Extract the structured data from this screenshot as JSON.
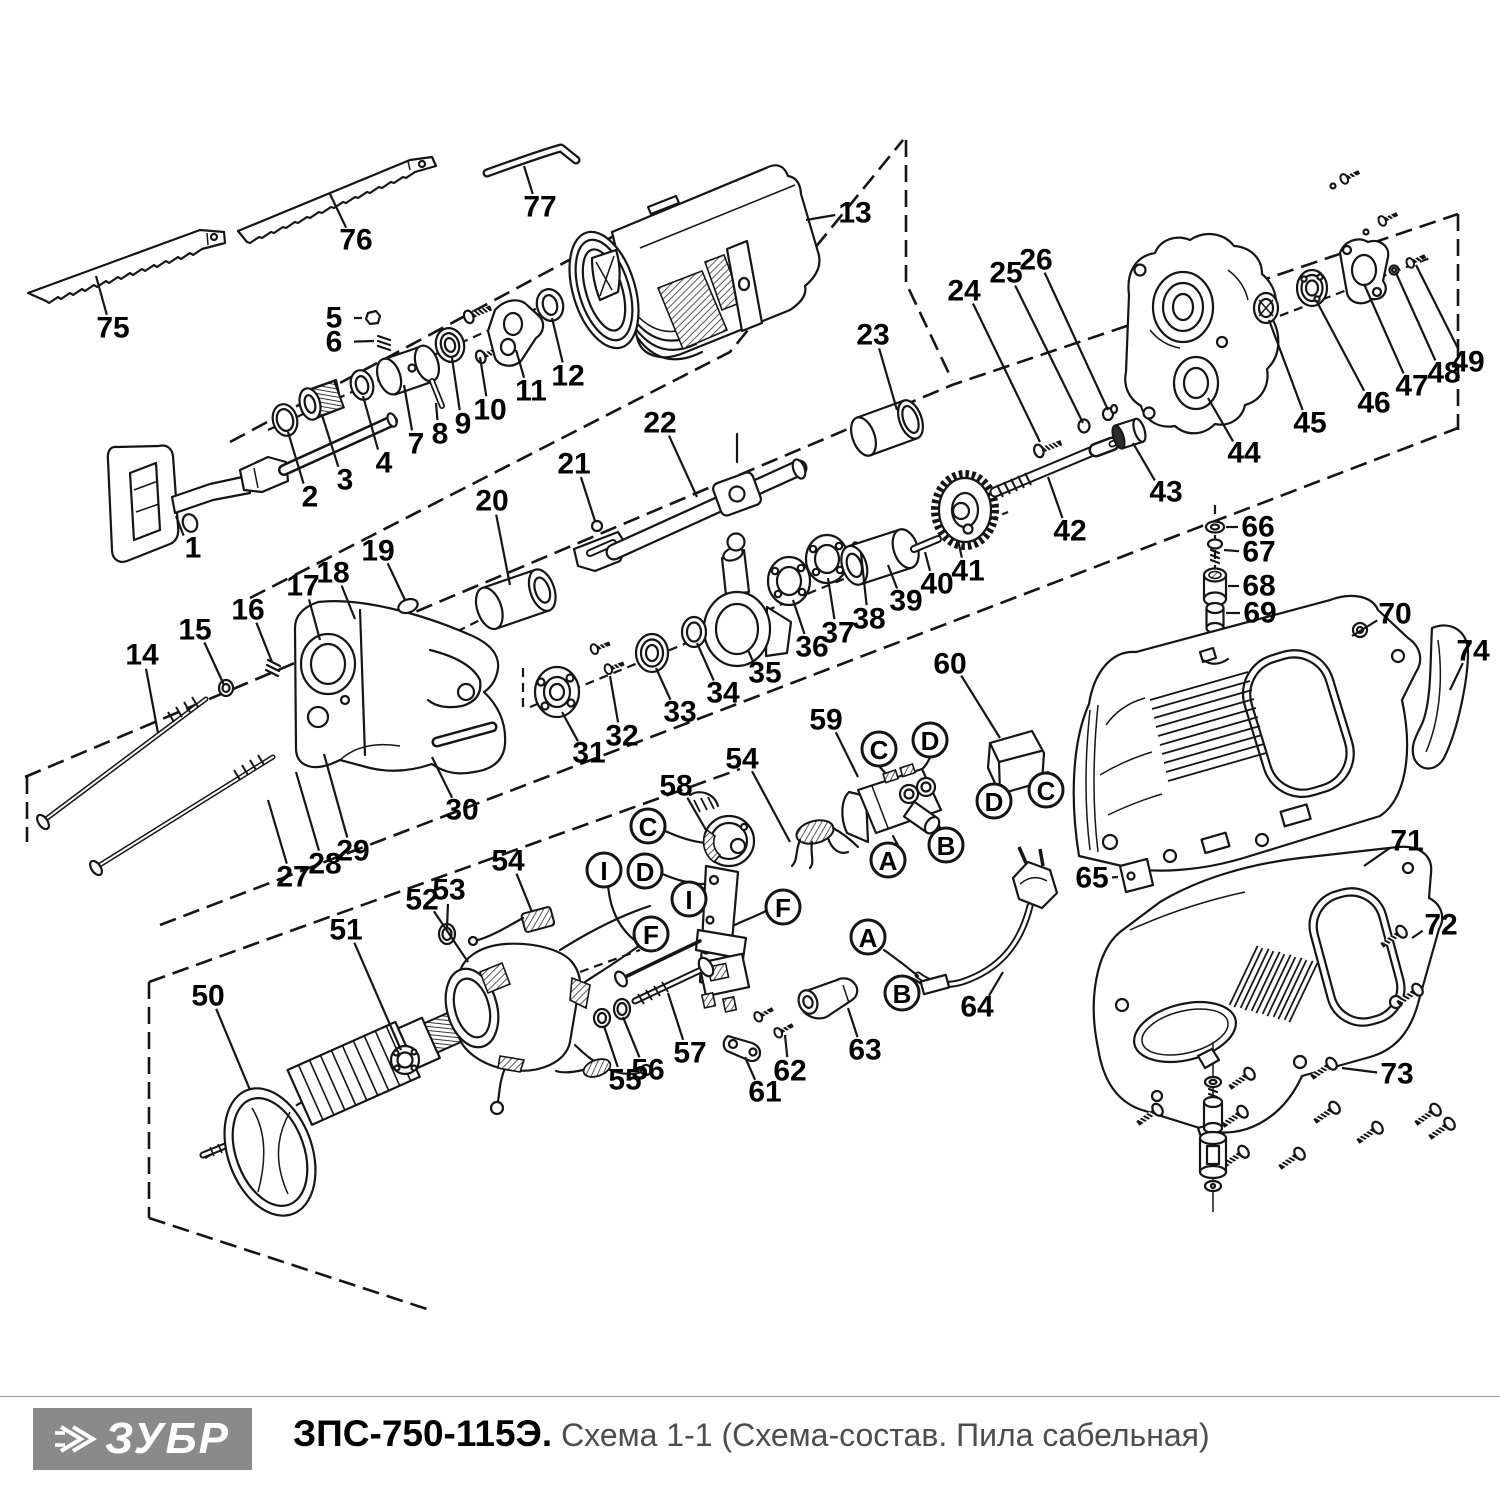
{
  "footer": {
    "brand": "ЗУБР",
    "model": "ЗПС-750-115Э.",
    "subtitle": " Схема 1-1 (Схема-состав. Пила сабельная)"
  },
  "colors": {
    "line": "#151515",
    "logo_bg": "#8a8a8a",
    "subtitle_text": "#4d4d4d"
  },
  "diagram": {
    "labels": [
      {
        "t": "1",
        "x": 193,
        "y": 548,
        "lx": 176,
        "ly": 516
      },
      {
        "t": "2",
        "x": 310,
        "y": 497,
        "lx": 288,
        "ly": 432
      },
      {
        "t": "3",
        "x": 345,
        "y": 480,
        "lx": 322,
        "ly": 415
      },
      {
        "t": "4",
        "x": 384,
        "y": 463,
        "lx": 363,
        "ly": 396
      },
      {
        "t": "5",
        "x": 334,
        "y": 318,
        "lx": 362,
        "ly": 318
      },
      {
        "t": "6",
        "x": 334,
        "y": 342,
        "lx": 374,
        "ly": 341
      },
      {
        "t": "7",
        "x": 416,
        "y": 444,
        "lx": 404,
        "ly": 385
      },
      {
        "t": "8",
        "x": 440,
        "y": 434,
        "lx": 436,
        "ly": 403
      },
      {
        "t": "9",
        "x": 463,
        "y": 424,
        "lx": 452,
        "ly": 358
      },
      {
        "t": "10",
        "x": 490,
        "y": 410,
        "lx": 480,
        "ly": 357
      },
      {
        "t": "11",
        "x": 531,
        "y": 391,
        "lx": 516,
        "ly": 350
      },
      {
        "t": "12",
        "x": 568,
        "y": 376,
        "lx": 552,
        "ly": 318
      },
      {
        "t": "13",
        "x": 855,
        "y": 213,
        "lx": 806,
        "ly": 220
      },
      {
        "t": "14",
        "x": 142,
        "y": 655,
        "lx": 158,
        "ly": 733
      },
      {
        "t": "15",
        "x": 195,
        "y": 630,
        "lx": 224,
        "ly": 685
      },
      {
        "t": "16",
        "x": 248,
        "y": 610,
        "lx": 272,
        "ly": 662
      },
      {
        "t": "17",
        "x": 303,
        "y": 586,
        "lx": 320,
        "ly": 640
      },
      {
        "t": "18",
        "x": 333,
        "y": 573,
        "lx": 355,
        "ly": 619
      },
      {
        "t": "19",
        "x": 378,
        "y": 551,
        "lx": 405,
        "ly": 600
      },
      {
        "t": "20",
        "x": 492,
        "y": 501,
        "lx": 510,
        "ly": 585
      },
      {
        "t": "21",
        "x": 574,
        "y": 464,
        "lx": 595,
        "ly": 521
      },
      {
        "t": "22",
        "x": 660,
        "y": 423,
        "lx": 697,
        "ly": 497
      },
      {
        "t": "23",
        "x": 873,
        "y": 335,
        "lx": 897,
        "ly": 410
      },
      {
        "t": "24",
        "x": 964,
        "y": 291,
        "lx": 1040,
        "ly": 442
      },
      {
        "t": "25",
        "x": 1006,
        "y": 273,
        "lx": 1083,
        "ly": 423
      },
      {
        "t": "26",
        "x": 1036,
        "y": 260,
        "lx": 1108,
        "ly": 410
      },
      {
        "t": "27",
        "x": 293,
        "y": 877,
        "lx": 268,
        "ly": 800
      },
      {
        "t": "28",
        "x": 325,
        "y": 864,
        "lx": 296,
        "ly": 772
      },
      {
        "t": "29",
        "x": 353,
        "y": 851,
        "lx": 324,
        "ly": 754
      },
      {
        "t": "30",
        "x": 462,
        "y": 810,
        "lx": 432,
        "ly": 757
      },
      {
        "t": "31",
        "x": 589,
        "y": 753,
        "lx": 562,
        "ly": 712
      },
      {
        "t": "32",
        "x": 622,
        "y": 736,
        "lx": 610,
        "ly": 676
      },
      {
        "t": "33",
        "x": 680,
        "y": 712,
        "lx": 656,
        "ly": 668
      },
      {
        "t": "34",
        "x": 723,
        "y": 693,
        "lx": 697,
        "ly": 643
      },
      {
        "t": "35",
        "x": 765,
        "y": 673,
        "lx": 748,
        "ly": 650
      },
      {
        "t": "36",
        "x": 812,
        "y": 647,
        "lx": 793,
        "ly": 600
      },
      {
        "t": "37",
        "x": 838,
        "y": 633,
        "lx": 828,
        "ly": 578
      },
      {
        "t": "38",
        "x": 869,
        "y": 619,
        "lx": 861,
        "ly": 553
      },
      {
        "t": "39",
        "x": 906,
        "y": 601,
        "lx": 888,
        "ly": 565
      },
      {
        "t": "40",
        "x": 937,
        "y": 584,
        "lx": 925,
        "ly": 552
      },
      {
        "t": "41",
        "x": 968,
        "y": 571,
        "lx": 958,
        "ly": 540
      },
      {
        "t": "42",
        "x": 1070,
        "y": 531,
        "lx": 1048,
        "ly": 477
      },
      {
        "t": "43",
        "x": 1166,
        "y": 492,
        "lx": 1133,
        "ly": 443
      },
      {
        "t": "44",
        "x": 1244,
        "y": 453,
        "lx": 1208,
        "ly": 398
      },
      {
        "t": "45",
        "x": 1310,
        "y": 423,
        "lx": 1269,
        "ly": 320
      },
      {
        "t": "46",
        "x": 1374,
        "y": 403,
        "lx": 1316,
        "ly": 300
      },
      {
        "t": "47",
        "x": 1412,
        "y": 386,
        "lx": 1364,
        "ly": 284
      },
      {
        "t": "48",
        "x": 1444,
        "y": 373,
        "lx": 1396,
        "ly": 273
      },
      {
        "t": "49",
        "x": 1468,
        "y": 362,
        "lx": 1416,
        "ly": 265
      },
      {
        "t": "50",
        "x": 208,
        "y": 996,
        "lx": 250,
        "ly": 1090
      },
      {
        "t": "51",
        "x": 346,
        "y": 930,
        "lx": 401,
        "ly": 1050
      },
      {
        "t": "52",
        "x": 422,
        "y": 900,
        "lx": 468,
        "ly": 962
      },
      {
        "t": "53",
        "x": 449,
        "y": 890,
        "lx": 447,
        "ly": 928
      },
      {
        "t": "54",
        "x": 508,
        "y": 861,
        "lx": 532,
        "ly": 912
      },
      {
        "t": "54",
        "x": 742,
        "y": 759,
        "lx": 790,
        "ly": 842
      },
      {
        "t": "55",
        "x": 625,
        "y": 1080,
        "lx": 604,
        "ly": 1026
      },
      {
        "t": "56",
        "x": 648,
        "y": 1070,
        "lx": 623,
        "ly": 1017
      },
      {
        "t": "57",
        "x": 690,
        "y": 1053,
        "lx": 668,
        "ly": 993
      },
      {
        "t": "58",
        "x": 676,
        "y": 786,
        "lx": 706,
        "ly": 830
      },
      {
        "t": "59",
        "x": 826,
        "y": 720,
        "lx": 858,
        "ly": 777
      },
      {
        "t": "60",
        "x": 950,
        "y": 664,
        "lx": 1000,
        "ly": 738
      },
      {
        "t": "61",
        "x": 765,
        "y": 1092,
        "lx": 745,
        "ly": 1057
      },
      {
        "t": "62",
        "x": 790,
        "y": 1071,
        "lx": 785,
        "ly": 1035
      },
      {
        "t": "63",
        "x": 865,
        "y": 1050,
        "lx": 848,
        "ly": 1008
      },
      {
        "t": "64",
        "x": 977,
        "y": 1007,
        "lx": 1003,
        "ly": 972
      },
      {
        "t": "65",
        "x": 1092,
        "y": 878,
        "lx": 1118,
        "ly": 877
      },
      {
        "t": "66",
        "x": 1258,
        "y": 527,
        "lx": 1226,
        "ly": 527
      },
      {
        "t": "67",
        "x": 1259,
        "y": 552,
        "lx": 1224,
        "ly": 550
      },
      {
        "t": "68",
        "x": 1259,
        "y": 586,
        "lx": 1228,
        "ly": 586
      },
      {
        "t": "69",
        "x": 1260,
        "y": 613,
        "lx": 1226,
        "ly": 613
      },
      {
        "t": "70",
        "x": 1395,
        "y": 614,
        "lx": 1352,
        "ly": 636
      },
      {
        "t": "71",
        "x": 1407,
        "y": 841,
        "lx": 1364,
        "ly": 866
      },
      {
        "t": "72",
        "x": 1441,
        "y": 925,
        "lx": 1412,
        "ly": 938
      },
      {
        "t": "73",
        "x": 1397,
        "y": 1074,
        "lx": 1342,
        "ly": 1068
      },
      {
        "t": "74",
        "x": 1473,
        "y": 651,
        "lx": 1450,
        "ly": 690
      },
      {
        "t": "75",
        "x": 113,
        "y": 328,
        "lx": 96,
        "ly": 276
      },
      {
        "t": "76",
        "x": 356,
        "y": 240,
        "lx": 330,
        "ly": 194
      },
      {
        "t": "77",
        "x": 540,
        "y": 207,
        "lx": 524,
        "ly": 166
      }
    ],
    "markers": [
      {
        "t": "C",
        "x": 879,
        "y": 749
      },
      {
        "t": "D",
        "x": 930,
        "y": 740
      },
      {
        "t": "A",
        "x": 888,
        "y": 860
      },
      {
        "t": "B",
        "x": 946,
        "y": 845
      },
      {
        "t": "D",
        "x": 994,
        "y": 801
      },
      {
        "t": "C",
        "x": 1046,
        "y": 790
      },
      {
        "t": "A",
        "x": 868,
        "y": 937
      },
      {
        "t": "B",
        "x": 902,
        "y": 993
      },
      {
        "t": "C",
        "x": 648,
        "y": 826
      },
      {
        "t": "D",
        "x": 645,
        "y": 871
      },
      {
        "t": "I",
        "x": 604,
        "y": 870
      },
      {
        "t": "I",
        "x": 689,
        "y": 899
      },
      {
        "t": "F",
        "x": 783,
        "y": 907
      },
      {
        "t": "F",
        "x": 651,
        "y": 934
      }
    ]
  }
}
